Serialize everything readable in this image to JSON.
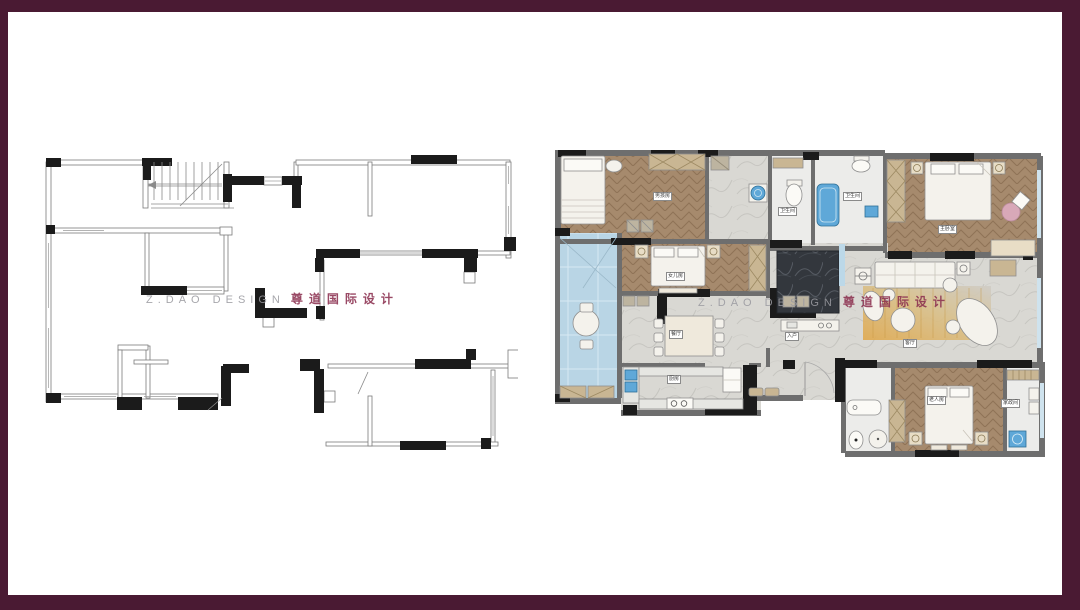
{
  "frame": {
    "border_color": "#4A1A33",
    "canvas_color": "#FFFFFF"
  },
  "watermark": {
    "latin": "Z.DAO DESIGN",
    "cjk": "尊道国际设计"
  },
  "rooms": {
    "boys_room": "男孩房",
    "daughters_room": "女儿房",
    "bathroom_a": "卫生间",
    "bathroom_b": "卫生间",
    "master_bedroom": "主卧室",
    "dining_room": "餐厅",
    "kitchen": "厨房",
    "entry": "入户",
    "living_room": "客厅",
    "elders_room": "老人房",
    "utility_room": "家政间"
  },
  "colors": {
    "frame": "#4A1A33",
    "wood_floor": "#A68A6D",
    "marble_floor": "#D9D8D3",
    "glass_balcony": "#B9D5E5",
    "fixture_blue": "#5FA8D8",
    "rug_amber": "#E0A94E",
    "wall_black": "#1B1B1B",
    "wall_gray": "#6E6E6E",
    "watermark_latin": "#9A9AA0",
    "watermark_cjk": "#8C3150"
  }
}
